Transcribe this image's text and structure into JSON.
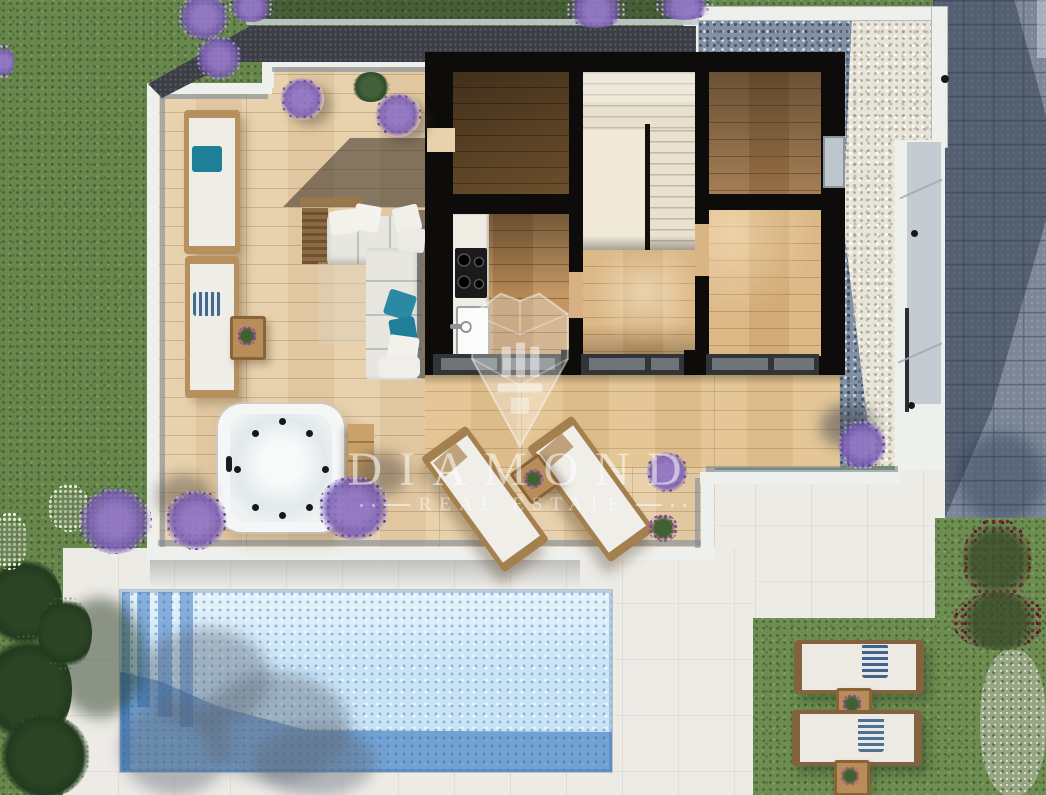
{
  "watermark": {
    "brand": "DIAMOND",
    "tagline": "REAL ESTATE"
  },
  "scene": {
    "type": "top-down 3D architectural floor plan render of a villa",
    "elements": [
      "garden-lawn",
      "roof-edge",
      "terrace-deck",
      "glass-balustrade",
      "outdoor-sofa",
      "sun-loungers",
      "hot-tub",
      "outdoor-kitchen-counter",
      "staircase",
      "hallway",
      "bedrooms",
      "sliding-glass-doors",
      "gravel-border",
      "concrete-walkway",
      "paver-driveway",
      "pool-patio",
      "swimming-pool",
      "lavender-bushes",
      "garden-bushes"
    ]
  },
  "palette": {
    "grass": "#67874D",
    "terrace_wood": "#E7CFA9",
    "interior_wood_gold": "#D9B37E",
    "interior_wood_dark": "#74552F",
    "wall_black": "#0D0C0A",
    "stairs_cream": "#E9E1CF",
    "pool_light_blue": "#CAE4F5",
    "pool_shadow_blue": "#2F6FB5",
    "patio_white": "#EDEBE6",
    "gravel_shadow": "#8291A4",
    "gravel_lit": "#E9E4D8",
    "pavers": "#7B8798",
    "roof_charcoal": "#3B3F45",
    "lavender": "#8A6FC2",
    "teal_pillow": "#1E7F99",
    "watermark_white": "rgba(255,255,255,0.55)"
  }
}
